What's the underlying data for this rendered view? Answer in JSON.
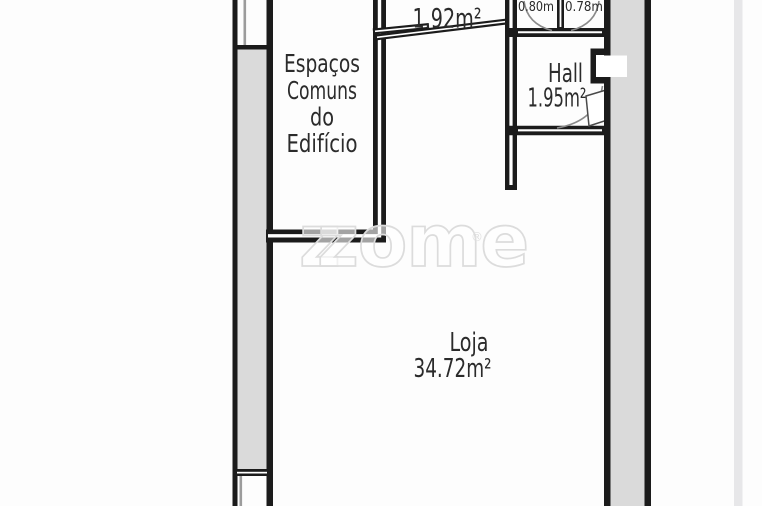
{
  "floor_plan": {
    "rooms": {
      "espacos_comuns": {
        "name_lines": [
          "Espaços",
          "Comuns",
          "do",
          "Edifício"
        ]
      },
      "storage_top": {
        "area_label": "1.92m²"
      },
      "closet_left": {
        "dim_label": "0.80m"
      },
      "closet_right": {
        "dim_label": "0.78m"
      },
      "hall": {
        "name": "Hall",
        "area_label": "1.95m²"
      },
      "loja": {
        "name": "Loja",
        "area_label": "34.72m²"
      }
    },
    "watermark": {
      "shadow_letter": "z",
      "text": "zome",
      "registered_mark": "®"
    },
    "colors": {
      "wall": "#1b1b1b",
      "shaft_fill": "#dadada",
      "label_text": "#2b2b2b",
      "watermark_stroke": "#dcdcdc",
      "door_arc": "#8a8a8a"
    }
  }
}
